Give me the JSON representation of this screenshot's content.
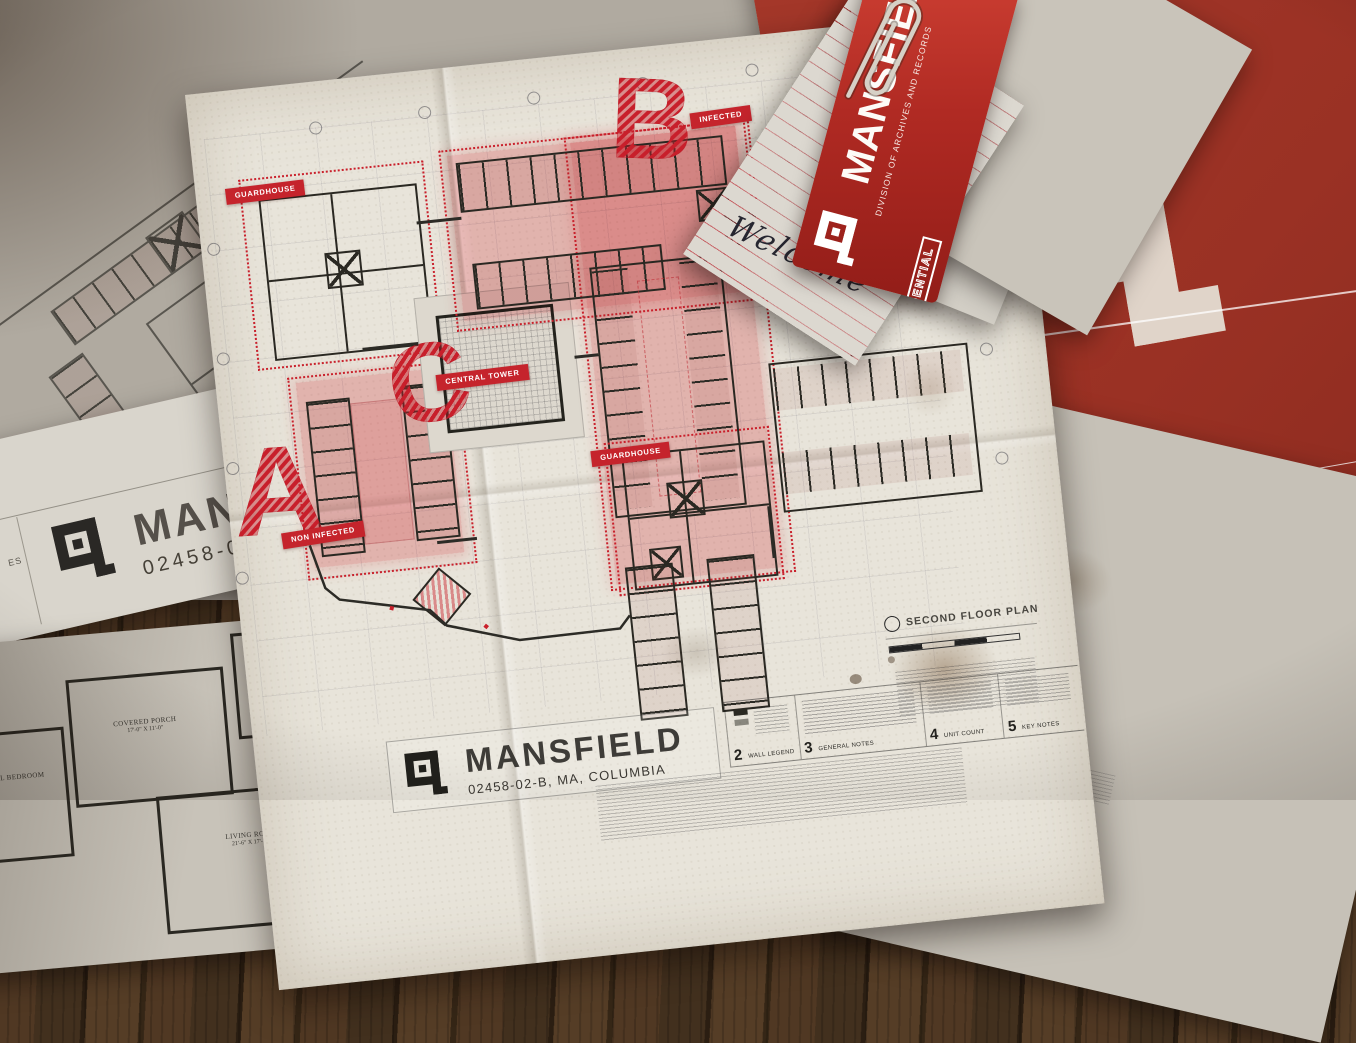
{
  "colors": {
    "accent_red": "#c5242c",
    "folder_red": "#9a3124",
    "zone_pink": "#e84b55",
    "paper_cream": "#e7e3d9",
    "wood_brown": "#3f2d1c"
  },
  "tag": {
    "brand": "MANSFIELD",
    "division": "DIVISION OF ARCHIVES AND RECORDS",
    "stamp": "CONFIDENTIAL"
  },
  "note": {
    "handwriting": "Welcome"
  },
  "blueprint": {
    "zones": {
      "a": {
        "letter": "A",
        "label": "NON INFECTED"
      },
      "b": {
        "letter": "B",
        "label": "INFECTED"
      },
      "c": {
        "letter": "C",
        "label": "CENTRAL TOWER"
      }
    },
    "guardhouse_label": "GUARDHOUSE",
    "title_block": {
      "brand": "MANSFIELD",
      "location": "02458-02-B, MA, COLUMBIA"
    },
    "drawing_title": "SECOND FLOOR PLAN",
    "footer_sections": [
      {
        "num": "2",
        "label": "WALL LEGEND"
      },
      {
        "num": "3",
        "label": "GENERAL NOTES"
      },
      {
        "num": "4",
        "label": "UNIT COUNT"
      },
      {
        "num": "5",
        "label": "KEY NOTES"
      }
    ]
  },
  "under_sheet": {
    "brand": "MANSFIELD",
    "code": "02458-02-B",
    "side_fragment": "ES"
  },
  "house_plan": {
    "rooms": [
      {
        "name": "MASTER BEDROOM",
        "dims": "17'-0\" X 13'-7\""
      },
      {
        "name": "COVERED PORCH",
        "dims": "17'-0\" X 11'-0\""
      },
      {
        "name": "LIVING ROOM",
        "dims": "21'-6\" X 17'-10\""
      },
      {
        "name": "OPTIONAL BEDROOM",
        "dims": ""
      }
    ]
  }
}
